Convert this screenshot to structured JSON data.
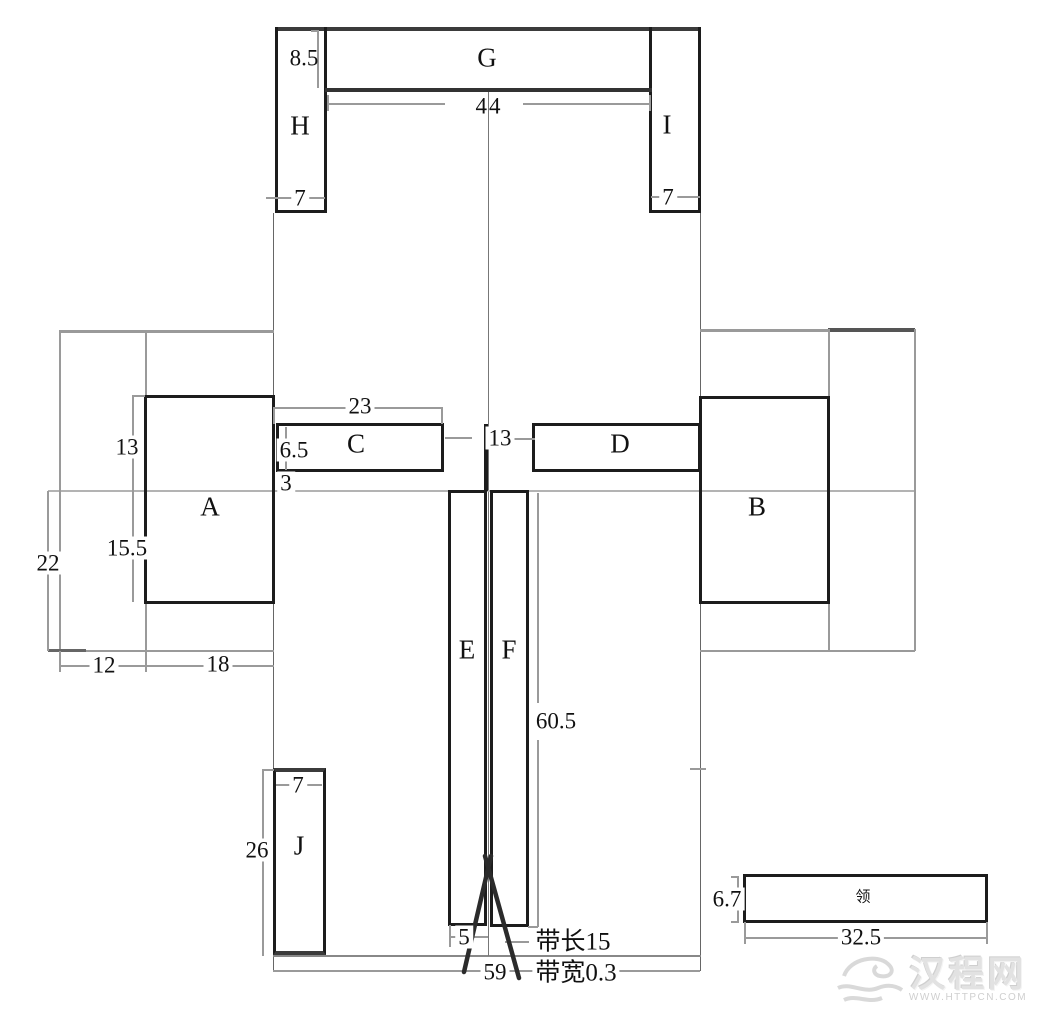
{
  "pieces": {
    "a": "A",
    "b": "B",
    "c": "C",
    "d": "D",
    "e": "E",
    "f": "F",
    "g": "G",
    "h": "H",
    "i": "I",
    "j": "J",
    "collar": "领"
  },
  "dims": {
    "g_height": "8.5",
    "g_width": "44",
    "h_bottom_width": "7",
    "i_bottom_width": "7",
    "c_width": "23",
    "c_height": "6.5",
    "c_to_fold": "3",
    "center_gap": "13",
    "a_upper_height": "13",
    "a_lower_height": "15.5",
    "a_width": "18",
    "left_margin": "12",
    "left_lower_height": "22",
    "ef_height": "60.5",
    "e_bottom_width": "5",
    "fabric_width": "59",
    "j_top_width": "7",
    "j_height": "26",
    "collar_height": "6.7",
    "collar_width": "32.5"
  },
  "annotations": {
    "strap_length_label": "带长15",
    "strap_width_label": "带宽0.3"
  },
  "watermark": {
    "brand": "汉程网",
    "url": "WWW.HTTPCN.COM"
  },
  "colors": {
    "piece_border": "#1c1c1c",
    "construction_line": "#9a9a9a",
    "dark_bar": "#3b3b3b",
    "fold_line": "#b3b3b3",
    "strap": "#2b2b2b",
    "watermark": "#dcdcdc"
  }
}
